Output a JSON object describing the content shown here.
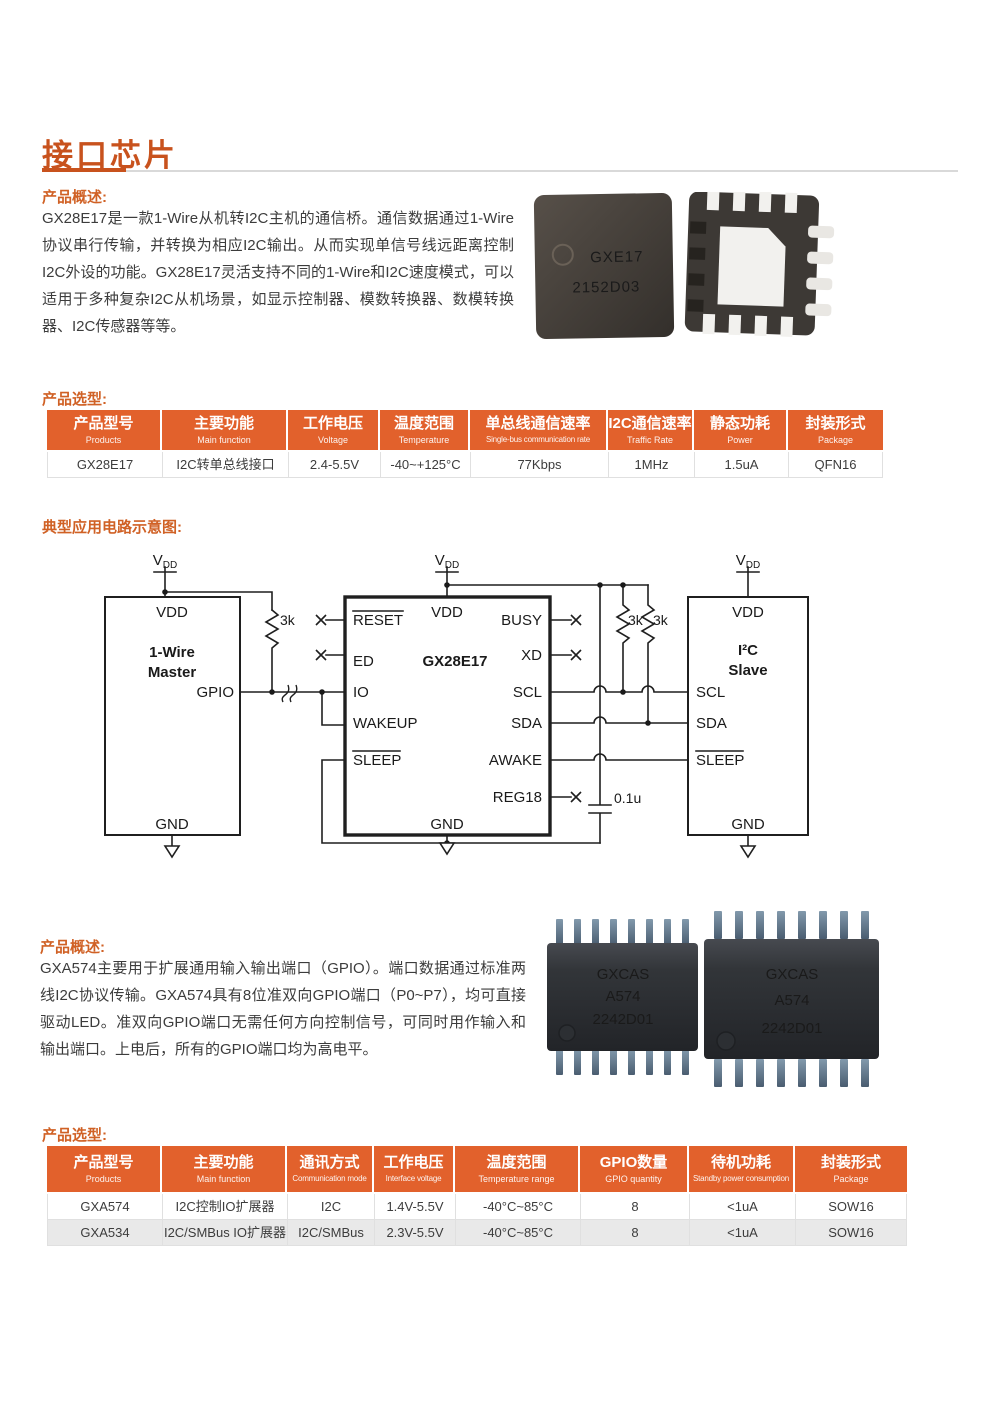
{
  "colors": {
    "accent_header": "#e2612c",
    "title_accent": "#c8521d",
    "section_accent": "#d06125",
    "row_alt": "#e9e9e9",
    "chip_body_dark": "#3c3834",
    "soic_lead_steel": "#64798c"
  },
  "page": {
    "title": "接口芯片"
  },
  "s1": {
    "overview_heading": "产品概述:",
    "overview_text": "GX28E17是一款1-Wire从机转I2C主机的通信桥。通信数据通过1-Wire协议串行传输，并转换为相应I2C输出。从而实现单信号线远距离控制I2C外设的功能。GX28E17灵活支持不同的1-Wire和I2C速度模式，可以适用于多种复杂I2C从机场景，如显示控制器、模数转换器、数模转换器、I2C传感器等等。",
    "selection_heading": "产品选型:",
    "circuit_heading": "典型应用电路示意图:",
    "chip_front": {
      "line1": "GXE17",
      "line2": "2152D03"
    },
    "table": {
      "headers": [
        {
          "zh": "产品型号",
          "en": "Products"
        },
        {
          "zh": "主要功能",
          "en": "Main function"
        },
        {
          "zh": "工作电压",
          "en": "Voltage"
        },
        {
          "zh": "温度范围",
          "en": "Temperature"
        },
        {
          "zh": "单总线通信速率",
          "en": "Single-bus communication rate"
        },
        {
          "zh": "I2C通信速率",
          "en": "Traffic Rate"
        },
        {
          "zh": "静态功耗",
          "en": "Power"
        },
        {
          "zh": "封装形式",
          "en": "Package"
        }
      ],
      "rows": [
        [
          "GX28E17",
          "I2C转单总线接口",
          "2.4-5.5V",
          "-40~+125°C",
          "77Kbps",
          "1MHz",
          "1.5uA",
          "QFN16"
        ]
      ]
    }
  },
  "circuit": {
    "vdd": {
      "main": "V",
      "sub": "DD"
    },
    "r_left": "3k",
    "r1": "3k",
    "r2": "3k",
    "cap": "0.1u",
    "master": {
      "top": "VDD",
      "name1": "1-Wire",
      "name2": "Master",
      "gpio": "GPIO",
      "bottom": "GND"
    },
    "bridge": {
      "top": "VDD",
      "name": "GX28E17",
      "bottom": "GND",
      "reset": "RESET",
      "ed": "ED",
      "io": "IO",
      "wakeup": "WAKEUP",
      "sleep": "SLEEP",
      "busy": "BUSY",
      "xd": "XD",
      "scl": "SCL",
      "sda": "SDA",
      "awake": "AWAKE",
      "reg18": "REG18"
    },
    "slave": {
      "top": "VDD",
      "name1": "I²C",
      "name2": "Slave",
      "scl": "SCL",
      "sda": "SDA",
      "sleep": "SLEEP",
      "bottom": "GND"
    }
  },
  "s2": {
    "overview_heading": "产品概述:",
    "overview_text": "GXA574主要用于扩展通用输入输出端口（GPIO）。端口数据通过标准两线I2C协议传输。GXA574具有8位准双向GPIO端口（P0~P7），均可直接驱动LED。准双向GPIO端口无需任何方向控制信号，可同时用作输入和输出端口。上电后，所有的GPIO端口均为高电平。",
    "selection_heading": "产品选型:",
    "chip": {
      "line1": "GXCAS",
      "line2": "A574",
      "line3": "2242D01"
    },
    "table": {
      "headers": [
        {
          "zh": "产品型号",
          "en": "Products"
        },
        {
          "zh": "主要功能",
          "en": "Main function"
        },
        {
          "zh": "通讯方式",
          "en": "Communication mode"
        },
        {
          "zh": "工作电压",
          "en": "Interface voltage"
        },
        {
          "zh": "温度范围",
          "en": "Temperature range"
        },
        {
          "zh": "GPIO数量",
          "en": "GPIO quantity"
        },
        {
          "zh": "待机功耗",
          "en": "Standby power consumption"
        },
        {
          "zh": "封装形式",
          "en": "Package"
        }
      ],
      "rows": [
        [
          "GXA574",
          "I2C控制IO扩展器",
          "I2C",
          "1.4V-5.5V",
          "-40°C~85°C",
          "8",
          "<1uA",
          "SOW16"
        ],
        [
          "GXA534",
          "I2C/SMBus IO扩展器",
          "I2C/SMBus",
          "2.3V-5.5V",
          "-40°C~85°C",
          "8",
          "<1uA",
          "SOW16"
        ]
      ]
    }
  }
}
